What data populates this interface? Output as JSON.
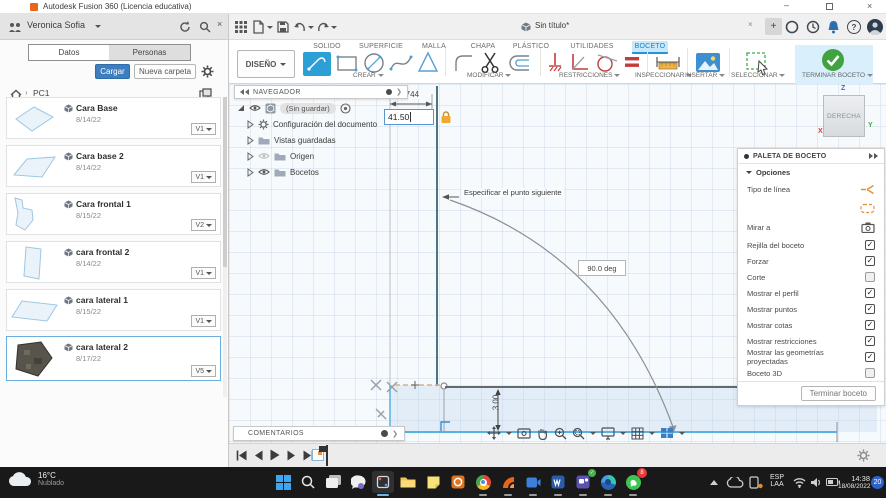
{
  "titlebar": {
    "title": "Autodesk Fusion 360 (Licencia educativa)"
  },
  "left_panel": {
    "user": "Veronica Sofia",
    "tabs": {
      "datos": "Datos",
      "personas": "Personas"
    },
    "actions": {
      "upload": "Cargar",
      "new_folder": "Nueva carpeta"
    },
    "breadcrumb": {
      "root": "PC1"
    },
    "files": [
      {
        "name": "Cara Base",
        "date": "8/14/22",
        "version": "V1"
      },
      {
        "name": "Cara base 2",
        "date": "8/14/22",
        "version": "V1"
      },
      {
        "name": "Cara frontal 1",
        "date": "8/15/22",
        "version": "V2"
      },
      {
        "name": "cara frontal 2",
        "date": "8/14/22",
        "version": "V1"
      },
      {
        "name": "cara lateral 1",
        "date": "8/15/22",
        "version": "V1"
      },
      {
        "name": "cara lateral 2",
        "date": "8/17/22",
        "version": "V5"
      }
    ]
  },
  "tabbar": {
    "document_tab": "Sin título*"
  },
  "ribbon": {
    "workspace_selector": "DISEÑO",
    "tabs": [
      "SOLIDO",
      "SUPERFICIE",
      "MALLA",
      "CHAPA",
      "PLÁSTICO",
      "UTILIDADES",
      "BOCETO"
    ],
    "groups": [
      "CREAR",
      "MODIFICAR",
      "RESTRICCIONES",
      "INSPECCIONAR",
      "INSERTAR",
      "SELECCIONAR",
      "TERMINAR BOCETO"
    ]
  },
  "navigator": {
    "title": "NAVEGADOR",
    "items": [
      "(Sin guardar)",
      "Configuración del documento",
      "Vistas guardadas",
      "Origen",
      "Bocetos"
    ]
  },
  "canvas": {
    "dimension_value": "3.744",
    "input_value": "41.50",
    "tooltip": "Especificar el punto siguiente",
    "angle_value": "90.0 deg",
    "height_dimension": "3.00",
    "viewcube": {
      "face": "DERECHA",
      "axis_z": "Z",
      "axis_y": "Y",
      "axis_x": "X"
    }
  },
  "sketch_palette": {
    "title": "PALETA DE BOCETO",
    "section": "Opciones",
    "options": [
      {
        "label": "Tipo de línea",
        "state": ""
      },
      {
        "label": "",
        "state": ""
      },
      {
        "label": "Mirar a",
        "state": ""
      },
      {
        "label": "Rejilla del boceto",
        "state": "✓"
      },
      {
        "label": "Forzar",
        "state": "✓"
      },
      {
        "label": "Corte",
        "state": ""
      },
      {
        "label": "Mostrar el perfil",
        "state": "✓"
      },
      {
        "label": "Mostrar puntos",
        "state": "✓"
      },
      {
        "label": "Mostrar cotas",
        "state": "✓"
      },
      {
        "label": "Mostrar restricciones",
        "state": "✓"
      },
      {
        "label": "Mostrar las geometrías proyectadas",
        "state": "✓"
      },
      {
        "label": "Boceto 3D",
        "state": ""
      }
    ],
    "finish_button": "Terminar boceto"
  },
  "comments": {
    "label": "COMENTARIOS"
  },
  "taskbar": {
    "weather": {
      "temp": "16°C",
      "condition": "Nublado"
    },
    "apps": [
      "windows",
      "search",
      "task-view",
      "chat",
      "snipping-tool",
      "explorer",
      "notes",
      "powerpoint",
      "chrome",
      "fusion-360",
      "camera",
      "word",
      "teams",
      "edge",
      "whatsapp"
    ],
    "whatsapp_badge": "8",
    "tray": {
      "lang1": "ESP",
      "lang2": "LAA",
      "time": "14:38",
      "date": "18/08/2022",
      "badge": "20"
    }
  }
}
